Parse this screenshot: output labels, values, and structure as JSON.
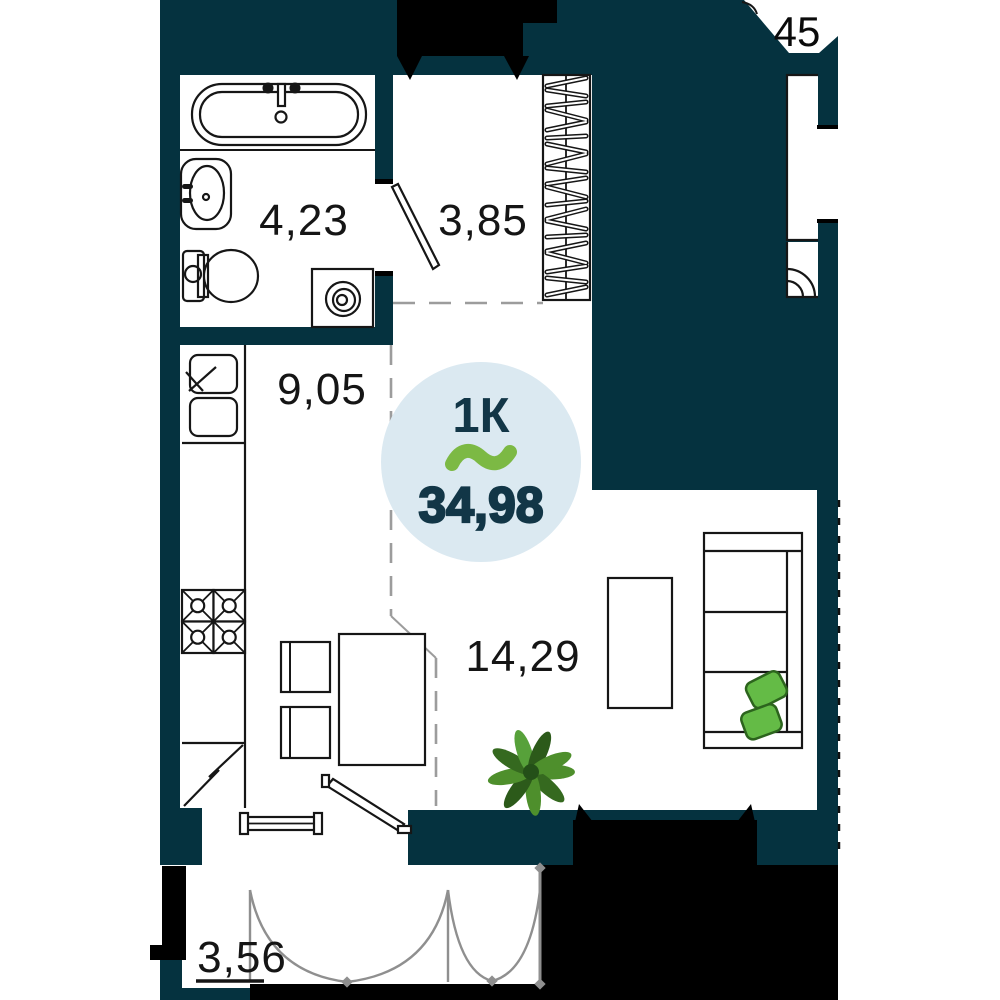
{
  "plan": {
    "title": "1-room apartment floor plan",
    "badge": {
      "unit_type": "1К",
      "total_area": "34,98",
      "logo": "tilde-wave"
    },
    "rooms": {
      "bathroom": {
        "area": "4,23"
      },
      "hallway": {
        "area": "3,85"
      },
      "kitchen": {
        "area": "9,05"
      },
      "living": {
        "area": "14,29"
      },
      "balcony": {
        "area": "3,56"
      }
    },
    "neighbor_unit_label": "45",
    "colors": {
      "wall_teal": "#05323f",
      "outline_black": "#000000",
      "badge_bg": "#dbe9f1",
      "badge_text": "#123647",
      "accent_green": "#7cb944",
      "pillow_green": "#64bb46",
      "pillow_outline": "#2c641d",
      "plant_green_dark": "#35691f",
      "plant_green_light": "#4e8f2c",
      "label_text": "#151515",
      "zone_line_gray": "#9c9c9c"
    },
    "fixtures": [
      "bathtub-icon",
      "bath-sink-icon",
      "toilet-icon",
      "washing-machine-icon",
      "interior-door-icon",
      "wardrobe-hangers-icon",
      "kitchen-sink-icon",
      "stove-burners-icon",
      "fridge-icon",
      "dining-table-icon",
      "chair-icon",
      "tv-stand-icon",
      "sofa-icon",
      "pillow-icon",
      "plant-icon",
      "entrance-door-icon",
      "window-icon",
      "balcony-door-icon",
      "balcony-glazing-icon"
    ]
  }
}
